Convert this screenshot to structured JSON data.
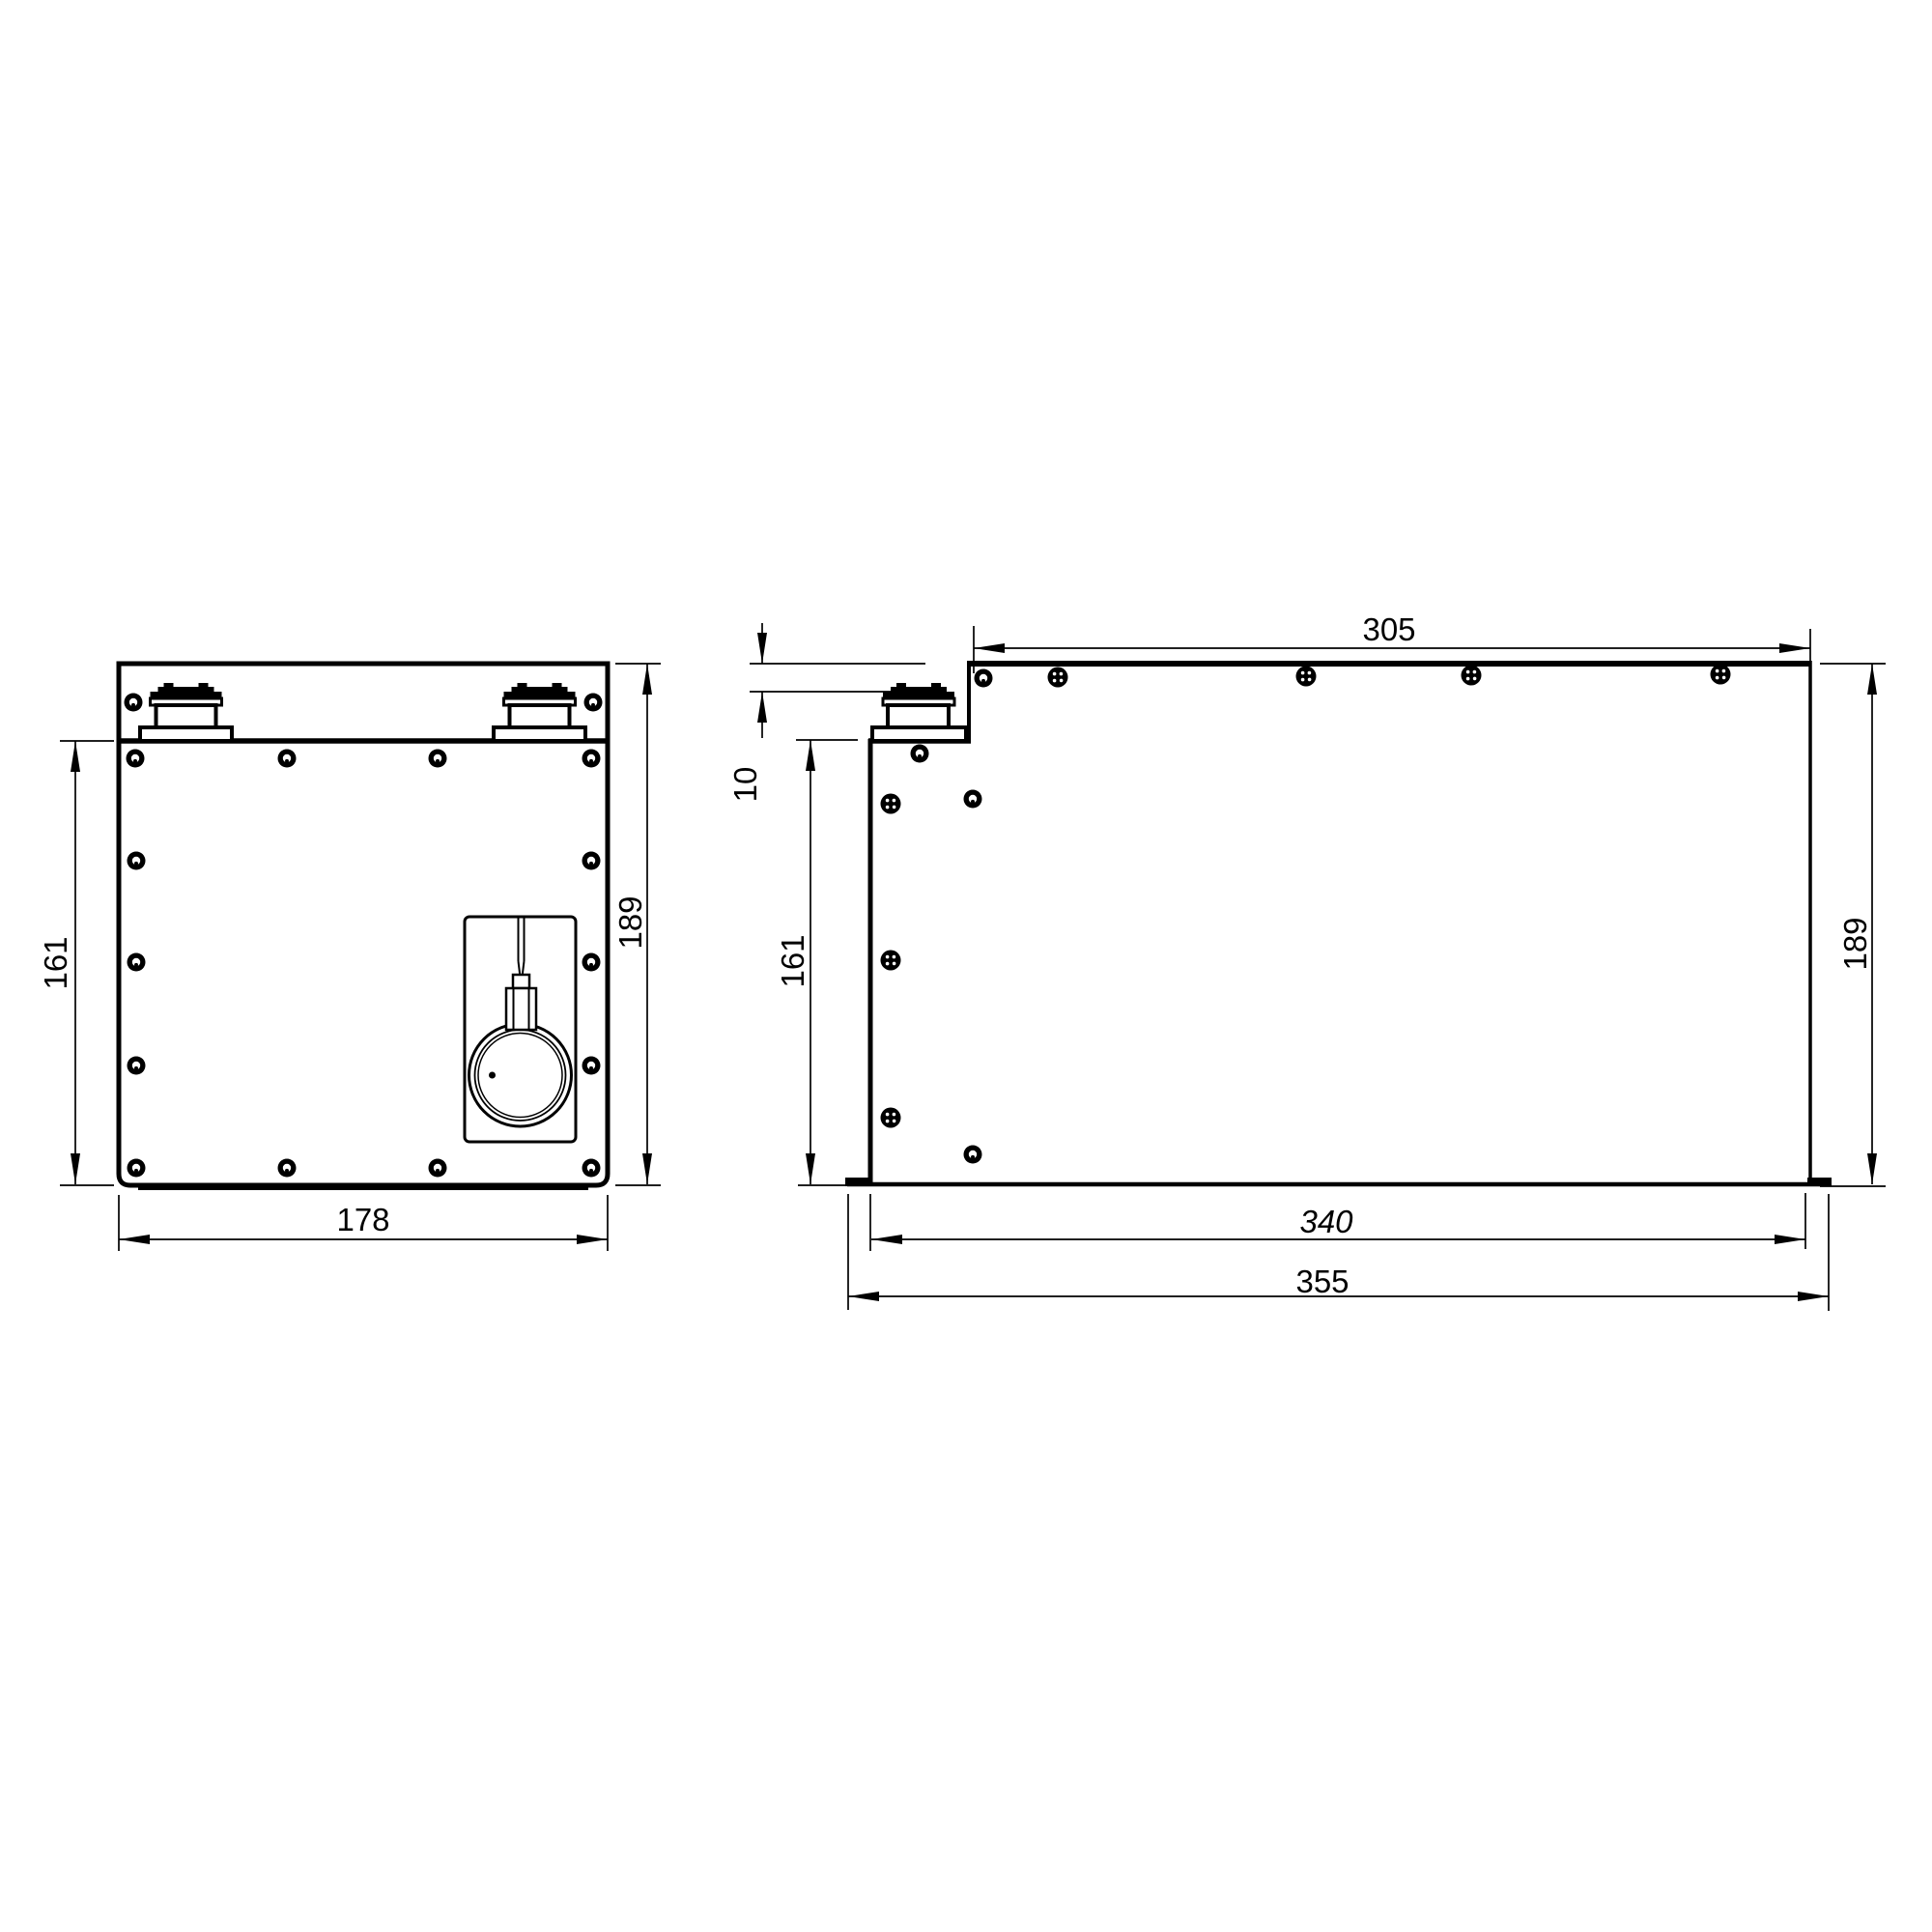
{
  "drawing": {
    "type": "engineering-dimension-drawing",
    "views": {
      "left": "front-view-battery-enclosure",
      "right": "side-view-battery-enclosure"
    },
    "dims": {
      "front_panel_height": "161",
      "front_height": "189",
      "front_width": "178",
      "side_top_width": "305",
      "side_step_depth": "10",
      "side_panel_height": "161",
      "side_height": "189",
      "side_base_length": "340",
      "side_overall_length": "355"
    },
    "colors": {
      "line": "#000000",
      "background": "#ffffff"
    }
  }
}
